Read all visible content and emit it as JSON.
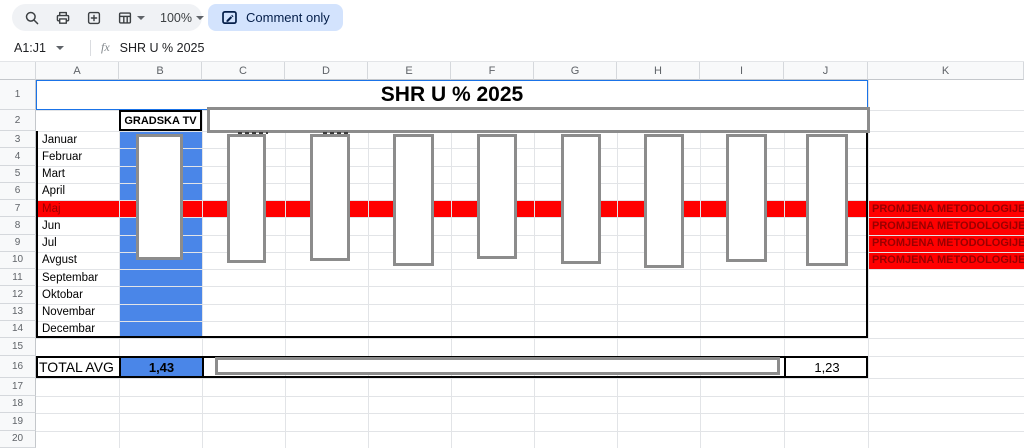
{
  "toolbar": {
    "zoom_label": "100%",
    "mode_chip": "Comment only",
    "icons": [
      "search-icon",
      "print-icon",
      "add-box-icon",
      "table-options-icon",
      "zoom-dropdown",
      "comment-mode-icon"
    ]
  },
  "formula_bar": {
    "name_box": "A1:J1",
    "fx_label": "fx",
    "formula": "SHR U % 2025"
  },
  "sheet": {
    "columns": [
      "A",
      "B",
      "C",
      "D",
      "E",
      "F",
      "G",
      "H",
      "I",
      "J",
      "K"
    ],
    "row_numbers": [
      "1",
      "2",
      "3",
      "4",
      "5",
      "6",
      "7",
      "8",
      "9",
      "10",
      "11",
      "12",
      "13",
      "14",
      "15",
      "16",
      "17",
      "18",
      "19",
      "20"
    ],
    "title": "SHR U % 2025",
    "header_b2": "GRADSKA TV",
    "months": [
      "Januar",
      "Februar",
      "Mart",
      "April",
      "Maj",
      "Jun",
      "Jul",
      "Avgust",
      "Septembar",
      "Oktobar",
      "Novembar",
      "Decembar"
    ],
    "highlighted_month": "Maj",
    "annotation": "PROMJENA METODOLOGIJE",
    "annotation_rows": [
      "7",
      "8",
      "9",
      "10"
    ],
    "total_row": {
      "label": "TOTAL AVG",
      "b_value": "1,43",
      "j_value": "1,23"
    },
    "colors": {
      "column_highlight": "#4a86e8",
      "row_highlight": "#ff0000",
      "annotation_text": "#990000",
      "selection": "#1a73e8",
      "chip_bg": "#d3e3fd",
      "chip_text": "#041e49"
    }
  }
}
